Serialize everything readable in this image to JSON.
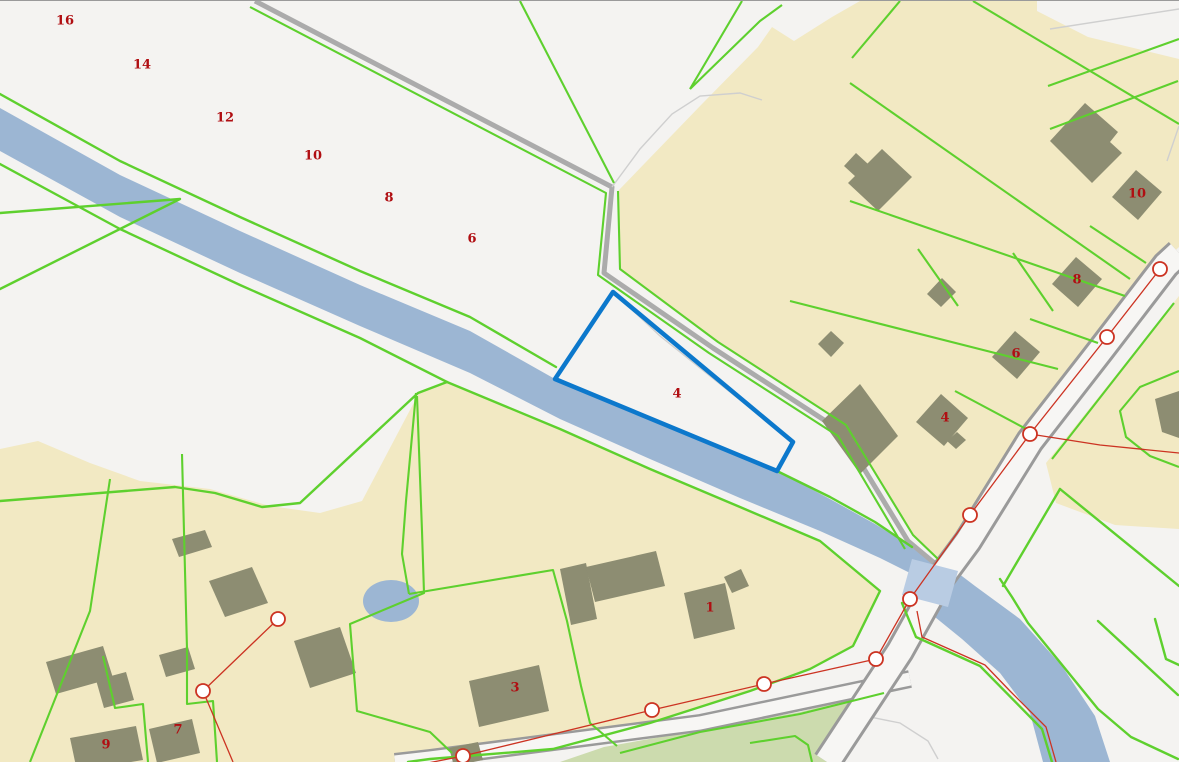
{
  "app": {
    "type": "cadastral-map-viewer"
  },
  "colors": {
    "field": "#f4f3f1",
    "builtup": "#f2e9c3",
    "water": "#9cb6d3",
    "water_bridge": "#b9cce3",
    "greenspace": "#ccdbae",
    "parcel_line": "#5ed02e",
    "building": "#8d8d72",
    "road_casing": "#9a9a9a",
    "road_fill": "#f7f6f4",
    "farm_path": "#ababab",
    "survey_line": "#cc3322",
    "marker_fill": "#ffffff",
    "label_color": "#b00e12",
    "selection": "#0c78cc"
  },
  "selected_parcel": {
    "label": "4"
  },
  "labels": {
    "parcel_numbers": [
      {
        "text": "16",
        "x": 65,
        "y": 20
      },
      {
        "text": "14",
        "x": 142,
        "y": 64
      },
      {
        "text": "12",
        "x": 225,
        "y": 117
      },
      {
        "text": "10",
        "x": 313,
        "y": 155
      },
      {
        "text": "8",
        "x": 389,
        "y": 197
      },
      {
        "text": "6",
        "x": 472,
        "y": 238
      },
      {
        "text": "10",
        "x": 1137,
        "y": 193
      },
      {
        "text": "8",
        "x": 1077,
        "y": 279
      },
      {
        "text": "6",
        "x": 1016,
        "y": 353
      },
      {
        "text": "4",
        "x": 945,
        "y": 417
      },
      {
        "text": "4",
        "x": 677,
        "y": 393
      },
      {
        "text": "1",
        "x": 710,
        "y": 607
      },
      {
        "text": "3",
        "x": 515,
        "y": 687
      },
      {
        "text": "7",
        "x": 178,
        "y": 729
      },
      {
        "text": "9",
        "x": 106,
        "y": 744
      }
    ]
  },
  "survey_markers": [
    [
      1160,
      268
    ],
    [
      1107,
      336
    ],
    [
      1030,
      433
    ],
    [
      970,
      514
    ],
    [
      910,
      598
    ],
    [
      876,
      658
    ],
    [
      764,
      683
    ],
    [
      652,
      709
    ],
    [
      463,
      755
    ],
    [
      278,
      618
    ],
    [
      203,
      690
    ]
  ]
}
